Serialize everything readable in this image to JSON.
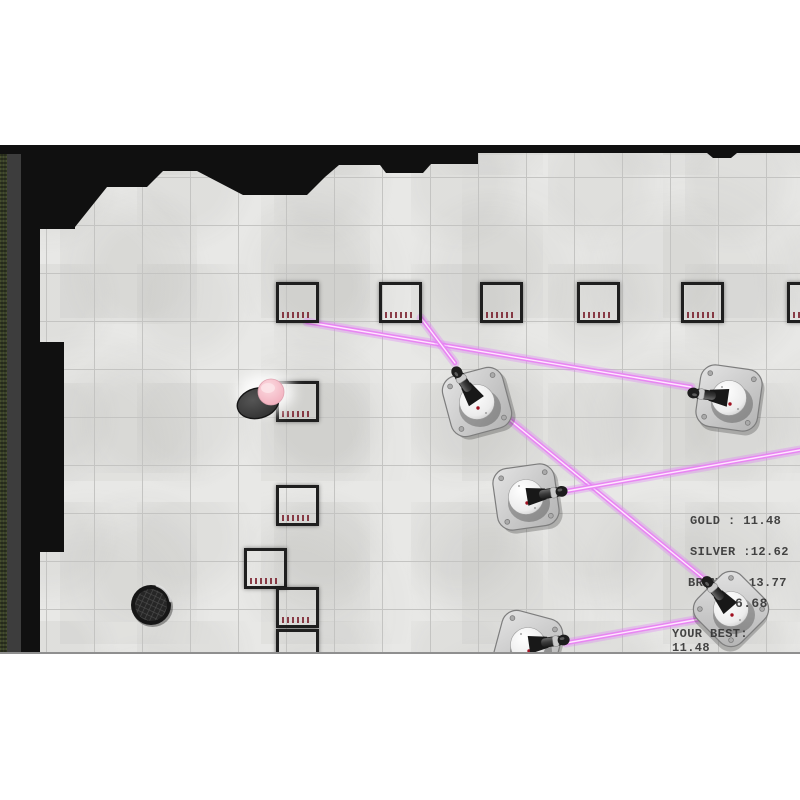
{
  "hud": {
    "gold": "GOLD : 11.48",
    "silver": "SILVER :12.62",
    "bronze": "BRONZE :13.77",
    "timer": "6.68",
    "your_best_label": "YOUR BEST:",
    "your_best_value": "11.48"
  },
  "colors": {
    "floor": "#e8e8e6",
    "grid_line": "#c4c4c2",
    "wall": "#101010",
    "wall_side": "#3d3d3d",
    "moss": "#39402a",
    "crate_red": "#e63744",
    "laser_glow": "rgba(224,120,248,0.32)",
    "laser_mid": "#e886f2",
    "laser_core": "#ffe6ff",
    "hud_text": "#2e2e2e"
  },
  "level": {
    "walls_path": "M0,0 L800,0 L800,8 L737,8 L731,13 L713,13 L707,8 L478,8 L478,19 L431,19 L423,28 L386,28 L380,20 L339,20 L325,32 L307,50 L243,50 L197,26 L163,26 L147,42 L107,42 L75,82 L75,84 L40,84 L40,197 L64,197 L64,407 L40,407 L40,510 L21,510 L21,9 L0,9 Z",
    "crate_size": {
      "w": 43,
      "h": 41
    },
    "crates": [
      {
        "x": 276,
        "y": 137
      },
      {
        "x": 379,
        "y": 137
      },
      {
        "x": 480,
        "y": 137
      },
      {
        "x": 577,
        "y": 137
      },
      {
        "x": 681,
        "y": 137
      },
      {
        "x": 787,
        "y": 137
      },
      {
        "x": 276,
        "y": 236
      },
      {
        "x": 276,
        "y": 340
      },
      {
        "x": 244,
        "y": 403
      },
      {
        "x": 276,
        "y": 442
      },
      {
        "x": 276,
        "y": 484
      }
    ],
    "turrets": [
      {
        "x": 477,
        "y": 257,
        "base_rot": -15,
        "barrel_rot": -124
      },
      {
        "x": 526,
        "y": 352,
        "base_rot": -8,
        "barrel_rot": -9
      },
      {
        "x": 729,
        "y": 253,
        "base_rot": 8,
        "barrel_rot": 188
      },
      {
        "x": 731,
        "y": 464,
        "base_rot": 45,
        "barrel_rot": -131
      },
      {
        "x": 528,
        "y": 500,
        "base_rot": 15,
        "barrel_rot": -8
      }
    ],
    "lasers": [
      {
        "x1": 691,
        "y1": 242,
        "x2": 307,
        "y2": 177
      },
      {
        "x1": 455,
        "y1": 218,
        "x2": 421,
        "y2": 173
      },
      {
        "x1": 708,
        "y1": 437,
        "x2": 499,
        "y2": 266
      },
      {
        "x1": 567,
        "y1": 346,
        "x2": 800,
        "y2": 305
      },
      {
        "x1": 566,
        "y1": 498,
        "x2": 700,
        "y2": 474
      }
    ],
    "player": {
      "x": 262,
      "y": 254
    },
    "vent": {
      "x": 151,
      "y": 460
    }
  }
}
